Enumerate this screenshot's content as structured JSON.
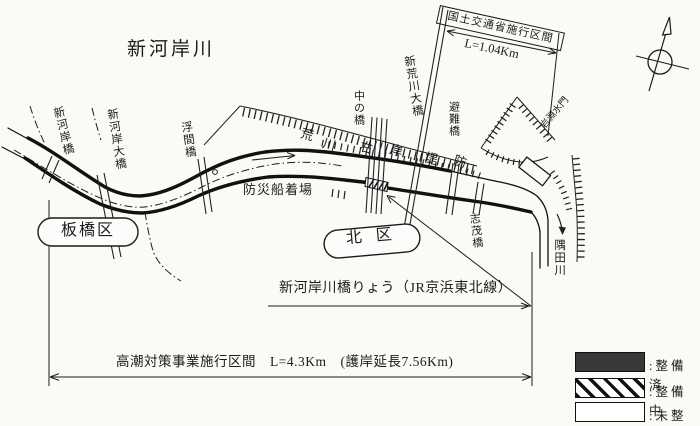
{
  "title": "新河岸川",
  "wards": {
    "itabashi": "板橋区",
    "kita": "北区"
  },
  "bridges": {
    "shingashibashi": "新河岸橋",
    "shingashi_ohashi": "新河岸大橋",
    "ukimabashi": "浮間橋",
    "nakanohashi": "中の橋",
    "shin_arakawa_ohashi": "新荒川大橋",
    "hinanbashi": "避難橋",
    "shimobashi": "志茂橋"
  },
  "rivers": {
    "sumidagawa": "隅田川"
  },
  "levee_chars": [
    "荒",
    "川",
    "右",
    "岸",
    "堤",
    "防"
  ],
  "facilities": {
    "dock": "防災船着場",
    "sluice": "岩淵水門"
  },
  "sections": {
    "mlit_label": "国土交通省施行区間",
    "mlit_length": "L=1.04Km",
    "storm_surge": "高潮対策事業施行区間　L=4.3Km　(護岸延長7.56Km)",
    "jr_bridge": "新河岸川橋りょう（JR京浜東北線）"
  },
  "legend": {
    "done": {
      "label": ":整備済",
      "color": "#383838"
    },
    "in_progress": {
      "label": ":整備中"
    },
    "not_yet": {
      "label": ":未整備"
    }
  },
  "colors": {
    "paper": "#fafaf7",
    "ink": "#1b1b1b"
  }
}
